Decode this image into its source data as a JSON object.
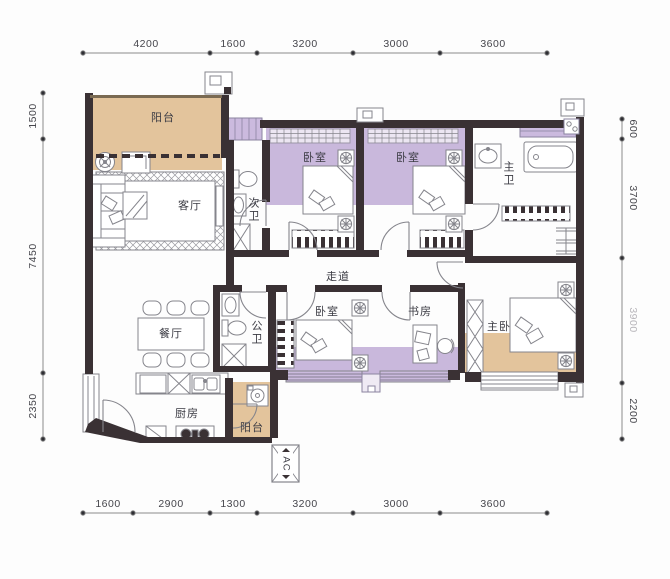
{
  "rooms": {
    "balcony_top": "阳台",
    "living": "客厅",
    "guest_bath": "次卫",
    "bedroom_a": "卧室",
    "bedroom_b": "卧室",
    "master_bath": "主卫",
    "corridor": "走道",
    "dining": "餐厅",
    "public_bath": "公卫",
    "bedroom_c": "卧室",
    "study": "书房",
    "master_bedroom": "主卧",
    "kitchen": "厨房",
    "balcony_small": "阳台",
    "ac_unit": "AC"
  },
  "dims": {
    "top": [
      "4200",
      "1600",
      "3200",
      "3000",
      "3600"
    ],
    "bottom": [
      "1600",
      "2900",
      "1300",
      "3200",
      "3000",
      "3600"
    ],
    "left": [
      "1500",
      "7450",
      "2350"
    ],
    "right": [
      "600",
      "3700",
      "3900",
      "2200"
    ]
  },
  "colors": {
    "wall": "#3a3134",
    "tan": "#e3c49c",
    "purple": "#c9b8dc",
    "purple_light": "#cbbade",
    "furniture_line": "#85858c",
    "dim_text": "#46464c",
    "dim_faded": "#b7b5ba"
  }
}
